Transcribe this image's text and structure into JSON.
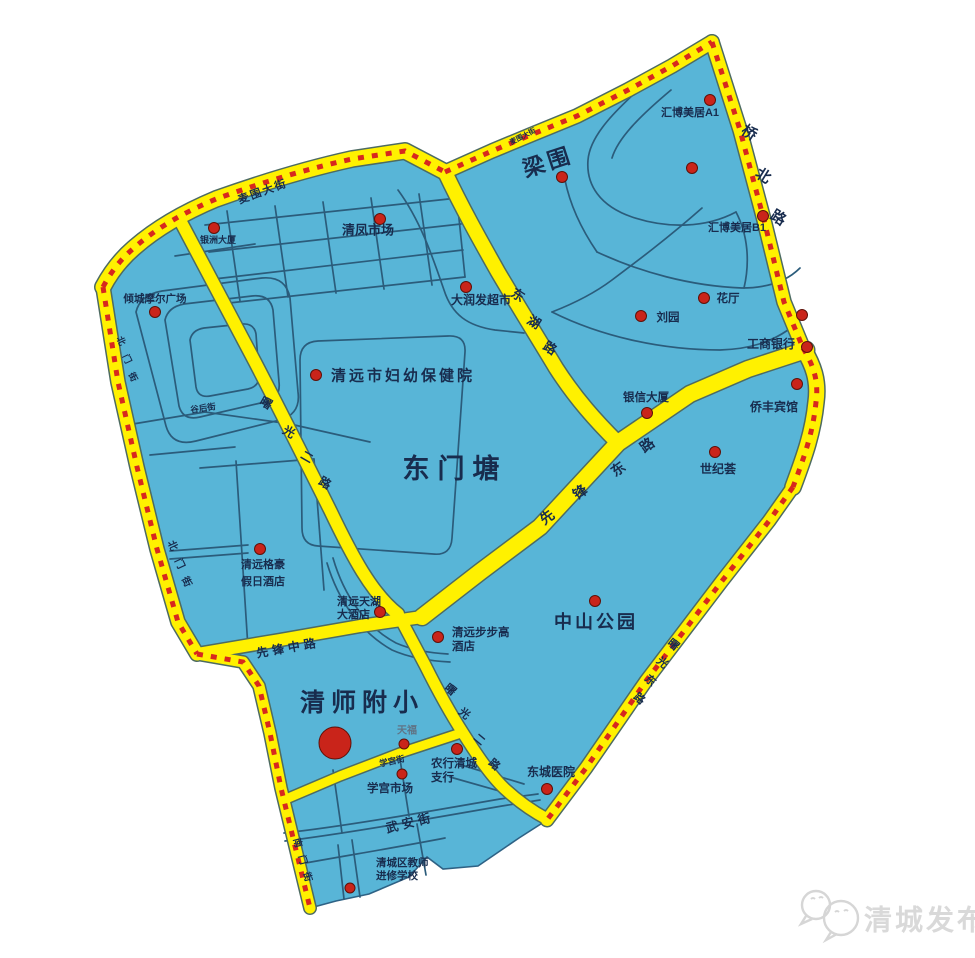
{
  "map": {
    "palette": {
      "area_blue": "#58b5d7",
      "area_edge": "#2e6285",
      "road_yellow": "#fff100",
      "road_casing": "#4d6b62",
      "border_dash_red": "#d7281e",
      "street_line": "#2b5c7b",
      "label_dark": "#182c4e",
      "poi_dot": "#c9241a",
      "poi_dot_edge": "#5f1008",
      "watermark_gray": "#d9d9d9"
    },
    "watermark": {
      "label": "清城发布",
      "icon": "wechat-doves-icon"
    },
    "labels": {
      "area": [
        {
          "name": "label-liangwei",
          "text": "梁围",
          "x": 548,
          "y": 162,
          "size": 22,
          "rotate": -18,
          "ls": 4
        },
        {
          "name": "label-dongmentang",
          "text": "东门塘",
          "x": 455,
          "y": 469,
          "size": 27,
          "ls": 8
        },
        {
          "name": "label-zhongshan-park",
          "text": "中山公园",
          "x": 596,
          "y": 622,
          "size": 18,
          "ls": 3
        },
        {
          "name": "label-qingshifuxiao",
          "text": "清师附小",
          "x": 362,
          "y": 703,
          "size": 25,
          "ls": 6
        }
      ],
      "poi": [
        {
          "name": "label-huibo-a1",
          "text": "汇博美居A1",
          "x": 690,
          "y": 113,
          "size": 11
        },
        {
          "name": "label-huibo-b1",
          "text": "汇博美居B1",
          "x": 737,
          "y": 228,
          "size": 11
        },
        {
          "name": "label-huating",
          "text": "花厅",
          "x": 728,
          "y": 299
        },
        {
          "name": "label-liuyuan",
          "text": "刘园",
          "x": 668,
          "y": 318
        },
        {
          "name": "label-gongshang-bank",
          "text": "工商银行",
          "x": 771,
          "y": 344,
          "size": 12
        },
        {
          "name": "label-yinxin-dasha",
          "text": "银信大厦",
          "x": 646,
          "y": 398
        },
        {
          "name": "label-qiaofeng-hotel",
          "text": "侨丰宾馆",
          "x": 774,
          "y": 407,
          "size": 12
        },
        {
          "name": "label-shijihui",
          "text": "世纪荟",
          "x": 718,
          "y": 469,
          "size": 12
        },
        {
          "name": "label-qingfeng-market",
          "text": "清凤市场",
          "x": 368,
          "y": 230,
          "size": 13
        },
        {
          "name": "label-darunfa",
          "text": "大润发超市",
          "x": 481,
          "y": 300,
          "size": 12
        },
        {
          "name": "label-fuyou-hospital",
          "text": "清远市妇幼保健院",
          "x": 403,
          "y": 376,
          "size": 15,
          "weight": "bold",
          "ls": 3
        },
        {
          "name": "label-yinzhou-dasha",
          "text": "银洲大厦",
          "x": 218,
          "y": 240,
          "size": 9
        },
        {
          "name": "label-qingcheng-moer",
          "text": "倾城摩尔广场",
          "x": 155,
          "y": 299,
          "size": 10.5
        },
        {
          "name": "label-gehao-hotel",
          "lines": [
            "清远格豪",
            "假日酒店"
          ],
          "text": "清远格豪假日酒店",
          "x": 263,
          "y": 565,
          "lh": 17,
          "size": 11
        },
        {
          "name": "label-tianhu-hotel",
          "lines": [
            "清远天湖",
            "大酒店"
          ],
          "text": "清远天湖大酒店",
          "x": 337,
          "y": 602,
          "lh": 13,
          "size": 11,
          "anchor": "start"
        },
        {
          "name": "label-bubugao-hotel",
          "lines": [
            "清远步步高",
            "酒店"
          ],
          "text": "清远步步高酒店",
          "x": 452,
          "y": 633,
          "lh": 14,
          "size": 11.5,
          "anchor": "start"
        },
        {
          "name": "label-tianfu",
          "text": "天福",
          "x": 407,
          "y": 731,
          "size": 10,
          "color": "#5f7486"
        },
        {
          "name": "label-nonghang",
          "lines": [
            "农行清城",
            "支行"
          ],
          "text": "农行清城支行",
          "x": 431,
          "y": 764,
          "lh": 14,
          "size": 11.5,
          "anchor": "start"
        },
        {
          "name": "label-xuegong-market",
          "text": "学宫市场",
          "x": 390,
          "y": 789,
          "size": 11.5
        },
        {
          "name": "label-dongcheng-hospital",
          "text": "东城医院",
          "x": 551,
          "y": 772,
          "size": 12
        },
        {
          "name": "label-jiaoshi-school",
          "lines": [
            "清城区教师",
            "进修学校"
          ],
          "text": "清城区教师进修学校",
          "x": 376,
          "y": 863,
          "lh": 13,
          "size": 10.5,
          "anchor": "start"
        }
      ],
      "road": [
        {
          "name": "road-label-maiwei-dajie",
          "text": "麦围大街",
          "x": 263,
          "y": 192,
          "rotate": -20,
          "size": 11,
          "ls": 2
        },
        {
          "name": "road-label-maiwei-small",
          "text": "麦围大街",
          "x": 523,
          "y": 137,
          "rotate": -27,
          "size": 7
        },
        {
          "name": "road-label-qiaobei-lu",
          "text": "桥北路",
          "chars": [
            [
              749,
              133
            ],
            [
              763,
              176
            ],
            [
              778,
              218
            ]
          ],
          "size": 15,
          "rotate": 32,
          "weight": "bold"
        },
        {
          "name": "road-label-donghu-lu",
          "text": "东湖路",
          "chars": [
            [
              518,
              295
            ],
            [
              534,
              322
            ],
            [
              550,
              348
            ]
          ],
          "size": 13,
          "rotate": 32
        },
        {
          "name": "road-label-xianfeng-donglu",
          "text": "先锋东路",
          "chars": [
            [
              547,
              517
            ],
            [
              580,
              492
            ],
            [
              618,
              469
            ],
            [
              647,
              445
            ]
          ],
          "size": 14,
          "rotate": -36
        },
        {
          "name": "road-label-xianfeng-zhonglu",
          "text": "先锋中路",
          "x": 288,
          "y": 648,
          "rotate": -10,
          "size": 12,
          "ls": 4
        },
        {
          "name": "road-label-shuguang-erlu-upper",
          "text": "曙光二路",
          "chars": [
            [
              266,
              403
            ],
            [
              289,
              432
            ],
            [
              307,
              457
            ],
            [
              325,
              483
            ]
          ],
          "size": 12,
          "rotate": 30
        },
        {
          "name": "road-label-shuguang-erlu-lower",
          "text": "曙光二路",
          "chars": [
            [
              450,
              690
            ],
            [
              464,
              714
            ],
            [
              479,
              740
            ],
            [
              494,
              765
            ]
          ],
          "size": 11,
          "rotate": 40
        },
        {
          "name": "road-label-shuguang-donglu",
          "text": "曙光东路",
          "chars": [
            [
              673,
              645
            ],
            [
              662,
              663
            ],
            [
              650,
              681
            ],
            [
              639,
              699
            ]
          ],
          "size": 11,
          "rotate": 40
        },
        {
          "name": "road-label-xuegong-jie",
          "text": "学宫街",
          "x": 392,
          "y": 761,
          "rotate": -12,
          "size": 8.5
        },
        {
          "name": "road-label-wuan-jie",
          "text": "武安街",
          "x": 410,
          "y": 823,
          "rotate": -14,
          "size": 12.5,
          "ls": 4
        },
        {
          "name": "road-label-guhou-jie",
          "text": "谷后街",
          "x": 203,
          "y": 408,
          "rotate": -8,
          "size": 8.5
        },
        {
          "name": "road-label-beimen-jie",
          "text": "北门街",
          "chars": [
            [
              172,
              546
            ],
            [
              179,
              564
            ],
            [
              186,
              582
            ]
          ],
          "size": 10,
          "rotate": 65
        },
        {
          "name": "road-label-beimen-jie-upper",
          "text": "北门街",
          "chars": [
            [
              121,
              341
            ],
            [
              127,
              359
            ],
            [
              133,
              377
            ]
          ],
          "size": 9,
          "rotate": 65
        },
        {
          "name": "road-label-nanmen-jie",
          "text": "南门街",
          "chars": [
            [
              297,
              843
            ],
            [
              302,
              860
            ],
            [
              307,
              877
            ]
          ],
          "size": 9.5,
          "rotate": 75
        }
      ]
    },
    "dots": [
      {
        "name": "dot-huibo-a1",
        "x": 710,
        "y": 100
      },
      {
        "name": "dot-liangwei-east",
        "x": 692,
        "y": 168
      },
      {
        "name": "dot-liangwei",
        "x": 562,
        "y": 177
      },
      {
        "name": "dot-huibo-b1",
        "x": 763,
        "y": 216
      },
      {
        "name": "dot-qingfeng-market",
        "x": 380,
        "y": 219
      },
      {
        "name": "dot-yinzhou-dasha",
        "x": 214,
        "y": 228
      },
      {
        "name": "dot-darunfa",
        "x": 466,
        "y": 287
      },
      {
        "name": "dot-huating",
        "x": 704,
        "y": 298
      },
      {
        "name": "dot-liuyuan",
        "x": 641,
        "y": 316
      },
      {
        "name": "dot-qiaobei",
        "x": 802,
        "y": 315
      },
      {
        "name": "dot-gongshang-bank",
        "x": 807,
        "y": 347
      },
      {
        "name": "dot-qingcheng-moer",
        "x": 155,
        "y": 312
      },
      {
        "name": "dot-fuyou-hospital",
        "x": 316,
        "y": 375
      },
      {
        "name": "dot-qiaofeng-hotel",
        "x": 797,
        "y": 384
      },
      {
        "name": "dot-yinxin-dasha",
        "x": 647,
        "y": 413
      },
      {
        "name": "dot-shijihui",
        "x": 715,
        "y": 452
      },
      {
        "name": "dot-gehao-hotel",
        "x": 260,
        "y": 549
      },
      {
        "name": "dot-tianhu-hotel",
        "x": 380,
        "y": 612
      },
      {
        "name": "dot-bubugao-hotel",
        "x": 438,
        "y": 637
      },
      {
        "name": "dot-zhongshan-park",
        "x": 595,
        "y": 601
      },
      {
        "name": "dot-qingshifuxiao",
        "x": 335,
        "y": 743,
        "r": 16
      },
      {
        "name": "dot-tianfu",
        "x": 404,
        "y": 744,
        "r": 5
      },
      {
        "name": "dot-nonghang",
        "x": 457,
        "y": 749
      },
      {
        "name": "dot-xuegong-market",
        "x": 402,
        "y": 774,
        "r": 5
      },
      {
        "name": "dot-dongcheng-hospital",
        "x": 547,
        "y": 789
      },
      {
        "name": "dot-jiaoshi-school",
        "x": 350,
        "y": 888,
        "r": 5
      }
    ]
  }
}
